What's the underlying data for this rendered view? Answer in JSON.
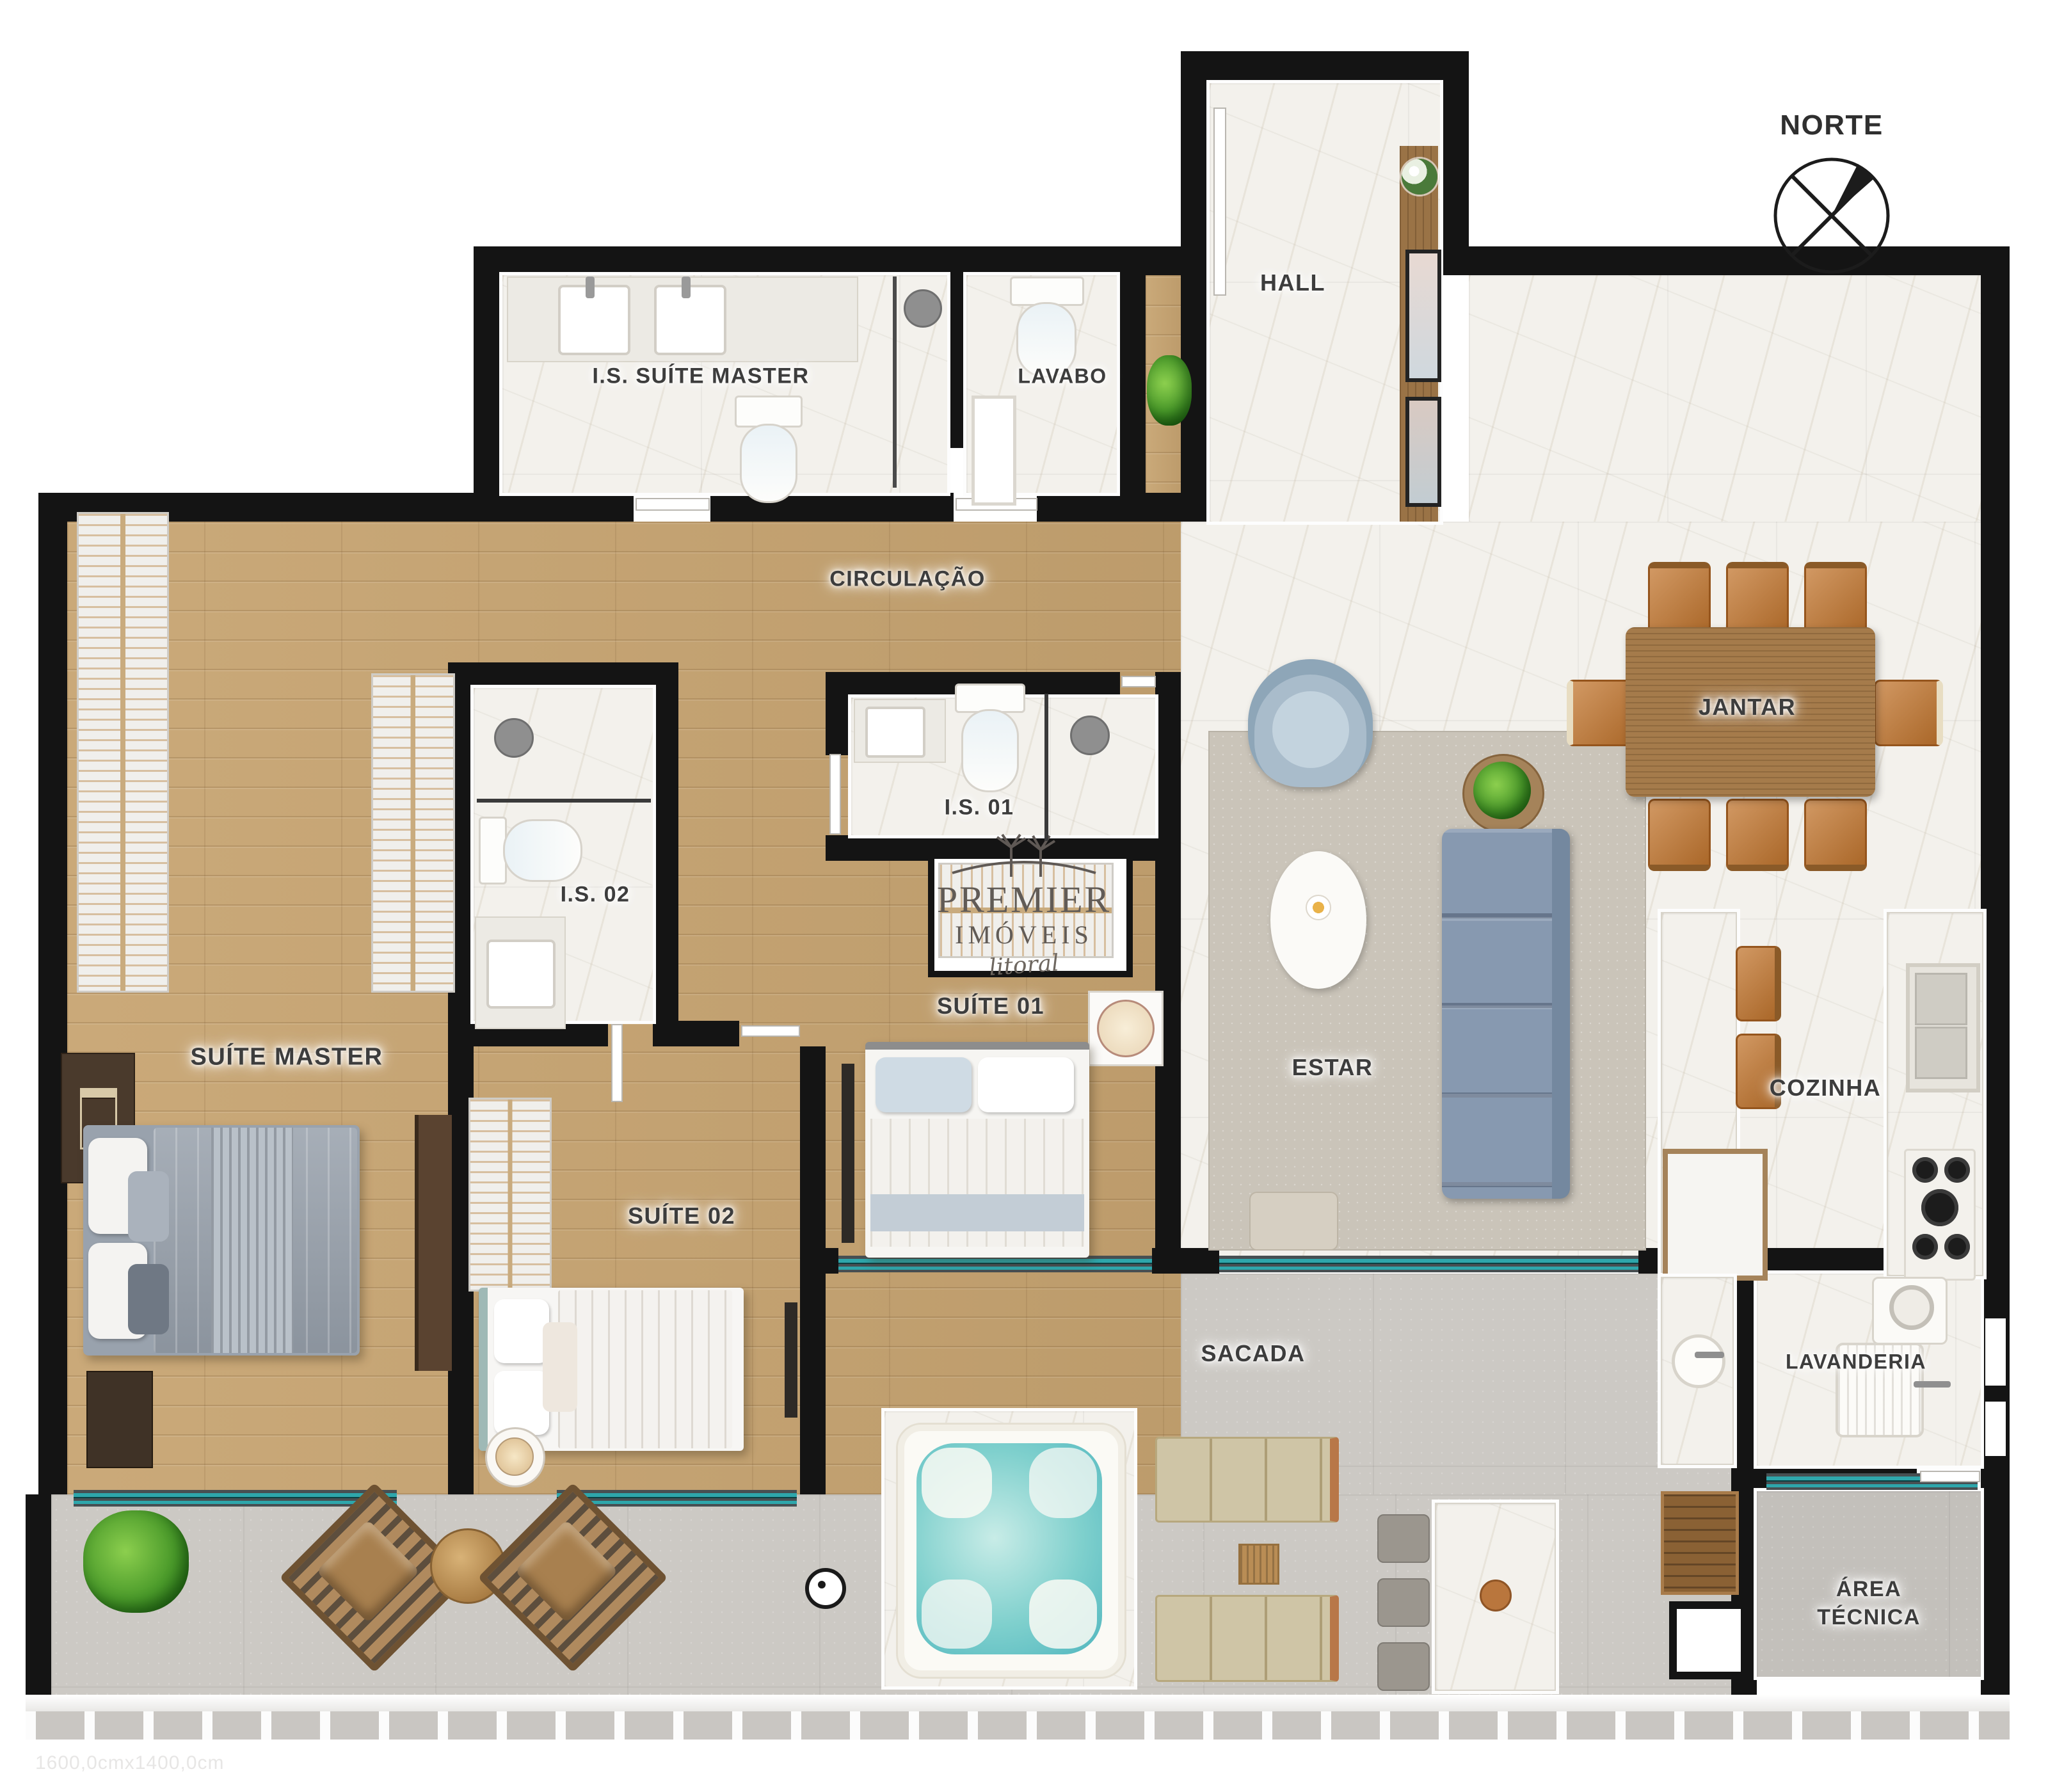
{
  "compass": {
    "label": "NORTE"
  },
  "rooms": [
    {
      "id": "is-suite-master",
      "label": "I.S. SUÍTE MASTER"
    },
    {
      "id": "lavabo",
      "label": "LAVABO"
    },
    {
      "id": "hall",
      "label": "HALL"
    },
    {
      "id": "circulacao",
      "label": "CIRCULAÇÃO"
    },
    {
      "id": "is-01",
      "label": "I.S. 01"
    },
    {
      "id": "is-02",
      "label": "I.S. 02"
    },
    {
      "id": "suite-master",
      "label": "SUÍTE MASTER"
    },
    {
      "id": "suite-01",
      "label": "SUÍTE 01"
    },
    {
      "id": "suite-02",
      "label": "SUÍTE 02"
    },
    {
      "id": "estar",
      "label": "ESTAR"
    },
    {
      "id": "jantar",
      "label": "JANTAR"
    },
    {
      "id": "cozinha",
      "label": "COZINHA"
    },
    {
      "id": "sacada",
      "label": "SACADA"
    },
    {
      "id": "lavanderia",
      "label": "LAVANDERIA"
    },
    {
      "id": "area-tecnica",
      "label": "ÁREA TÉCNICA"
    }
  ],
  "logo": {
    "brand": "PREMIER",
    "brand2": "IMÓVEIS",
    "script": "litoral"
  },
  "footer": {
    "dimensions_note": "1600,0cmx1400,0cm"
  },
  "colors": {
    "wall": "#141414",
    "wood_floor": "#c7a471",
    "marble_floor": "#f3f1ec",
    "balcony_floor": "#ccc9c4",
    "glass_door": "#2ea6ab",
    "sofa_blue": "#8799b0",
    "leather_chair": "#c2762f",
    "spa_water": "#7fd0cd",
    "label_text": "#3d3d3d"
  }
}
